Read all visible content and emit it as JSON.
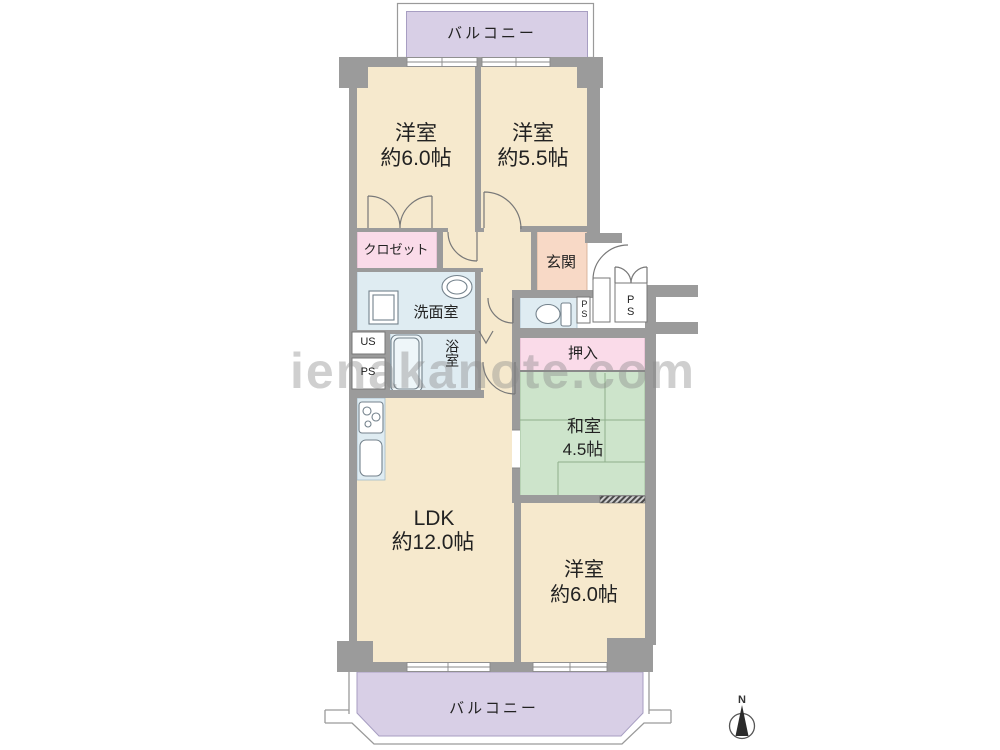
{
  "meta": {
    "type": "apartment-floorplan"
  },
  "watermark": "ienakanote.com",
  "compass": {
    "north_label": "N"
  },
  "balcony_top": {
    "label": "バルコニー"
  },
  "balcony_bottom": {
    "label": "バルコニー"
  },
  "rooms": {
    "bedroom_top_left": {
      "name": "洋室",
      "size": "約6.0帖"
    },
    "bedroom_top_right": {
      "name": "洋室",
      "size": "約5.5帖"
    },
    "closet": {
      "label": "クロゼット"
    },
    "entrance": {
      "label": "玄関"
    },
    "washroom": {
      "label": "洗面室"
    },
    "bathroom": {
      "label": "浴室"
    },
    "utility_shaft": {
      "label": "US"
    },
    "pipe_space_left": {
      "label": "PS"
    },
    "pipe_space_small": {
      "label": "PS"
    },
    "pipe_space_entry": {
      "label": "PS"
    },
    "oshiire_closet": {
      "label": "押入"
    },
    "japanese_room": {
      "name": "和室",
      "size": "4.5帖"
    },
    "ldk": {
      "name": "LDK",
      "size": "約12.0帖"
    },
    "bedroom_bottom": {
      "name": "洋室",
      "size": "約6.0帖"
    }
  },
  "palette": {
    "wall_gray": "#9b9b9b",
    "room_cream": "#f6e9cd",
    "balcony_purple": "#d8cfe6",
    "closet_pink": "#fadbe9",
    "entrance_peach": "#f8d9c6",
    "wet_area_blue": "#dfecf2",
    "tatami_green": "#cde4cb",
    "watermark_gray": "#878787"
  }
}
